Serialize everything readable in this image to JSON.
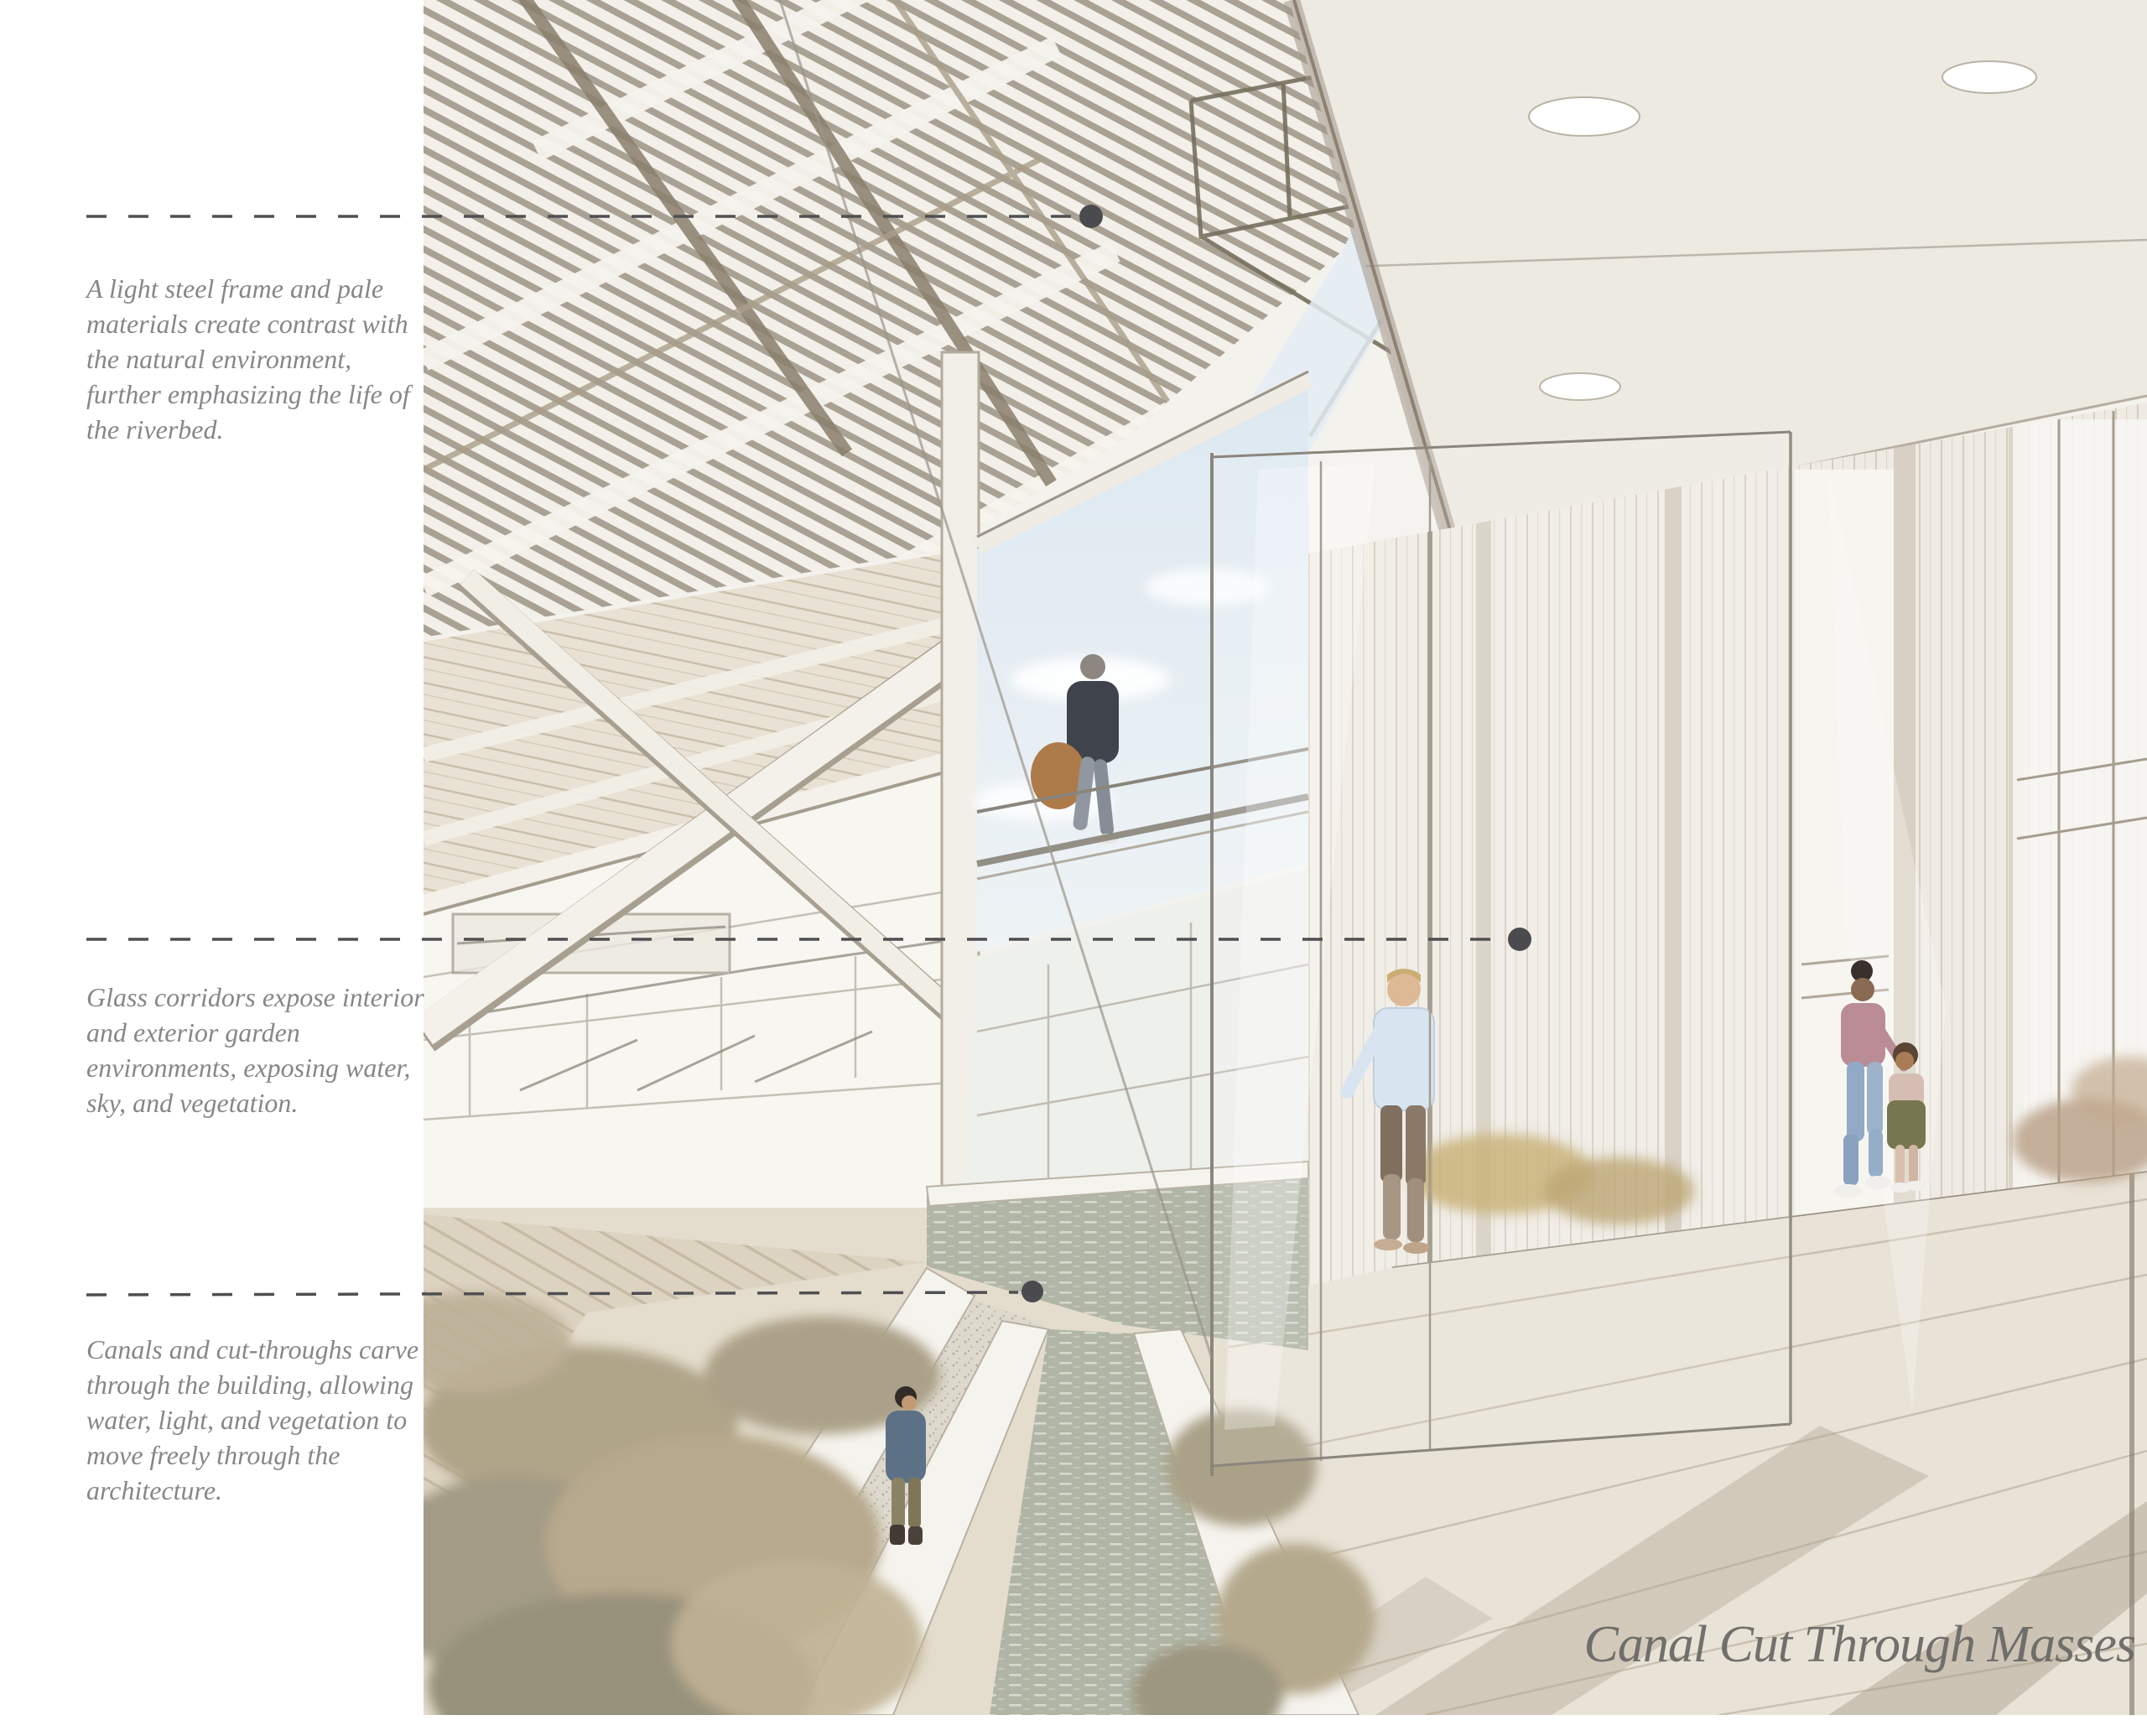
{
  "title": {
    "label": "Canal Cut Through Masses"
  },
  "annotations": [
    {
      "text": "A light steel frame and pale materials create contrast with the natural environment, further emphasizing the life of the riverbed.",
      "lines": [
        "A light steel frame and pale",
        "materials create contrast with",
        "the natural environment,",
        "further emphasizing the life of",
        "the riverbed."
      ]
    },
    {
      "text": "Glass corridors expose interior and exterior garden environments, exposing water, sky, and vegetation.",
      "lines": [
        "Glass corridors expose interior",
        "and exterior garden",
        "environments, exposing water,",
        "sky, and vegetation."
      ]
    },
    {
      "text": "Canals and cut-throughs carve through the building, allowing water, light, and vegetation to move freely through the architecture.",
      "lines": [
        "Canals and cut-throughs carve",
        "through the building, allowing",
        "water, light, and vegetation to",
        "move freely through the",
        "architecture."
      ]
    }
  ],
  "colors": {
    "annotation_text": "#87868a",
    "leader_line": "#4f4f52",
    "title_text": "#6b6a67",
    "water": "#afb4a4",
    "vegetation": "#b3a68d",
    "wood_floor": "#e8e2d6",
    "ceiling": "#edeae2",
    "roof_slat": "#968e7d",
    "sky": "#e3ecf3"
  }
}
